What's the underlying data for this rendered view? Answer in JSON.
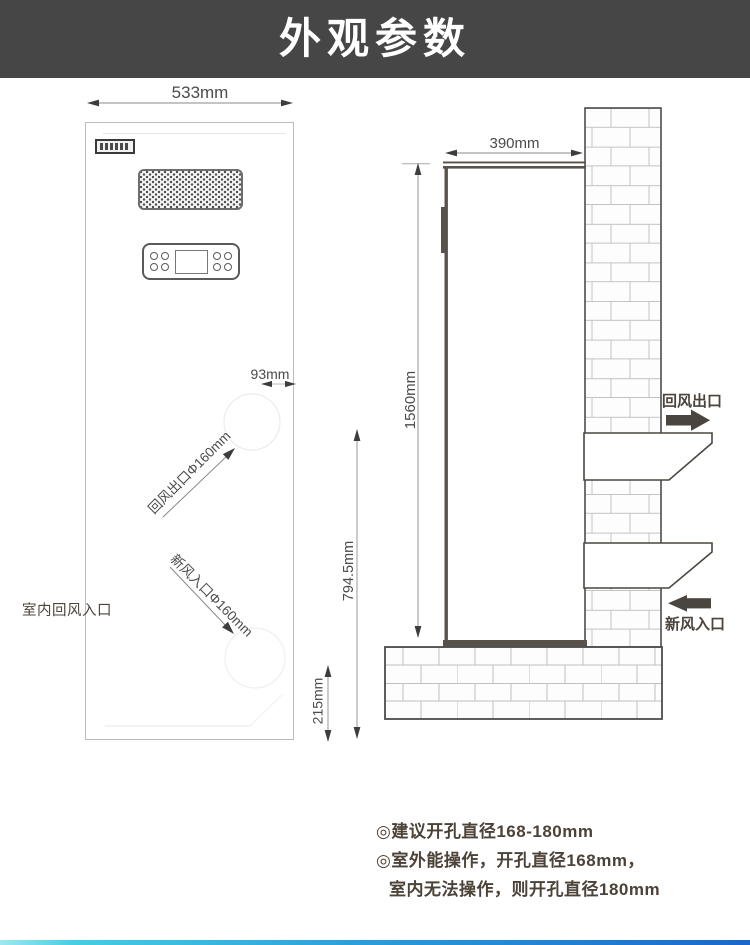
{
  "header": {
    "title": "外观参数"
  },
  "front_view": {
    "dims": {
      "width": "533mm",
      "hole_offset": "93mm",
      "bottom_section": "215mm"
    },
    "labels": {
      "return_outlet_hole": "回风出口Φ160mm",
      "fresh_inlet_hole": "新风入口Φ160mm",
      "indoor_return_inlet": "室内回风入口"
    }
  },
  "side_view": {
    "dims": {
      "depth": "390mm",
      "height": "1560mm",
      "hole_height": "794.5mm"
    },
    "labels": {
      "return_air_outlet": "回风出口",
      "fresh_air_inlet": "新风入口"
    }
  },
  "notes": {
    "lines": [
      "◎建议开孔直径168-180mm",
      "◎室外能操作，开孔直径168mm，",
      "室内无法操作，则开孔直径180mm"
    ]
  },
  "colors": {
    "header_bg": "#464646",
    "diagram_dark": "#4a463f",
    "note_text": "#4c4238",
    "bottom_bar_left": "#45cde2",
    "bottom_bar_right": "#1b66c9"
  }
}
